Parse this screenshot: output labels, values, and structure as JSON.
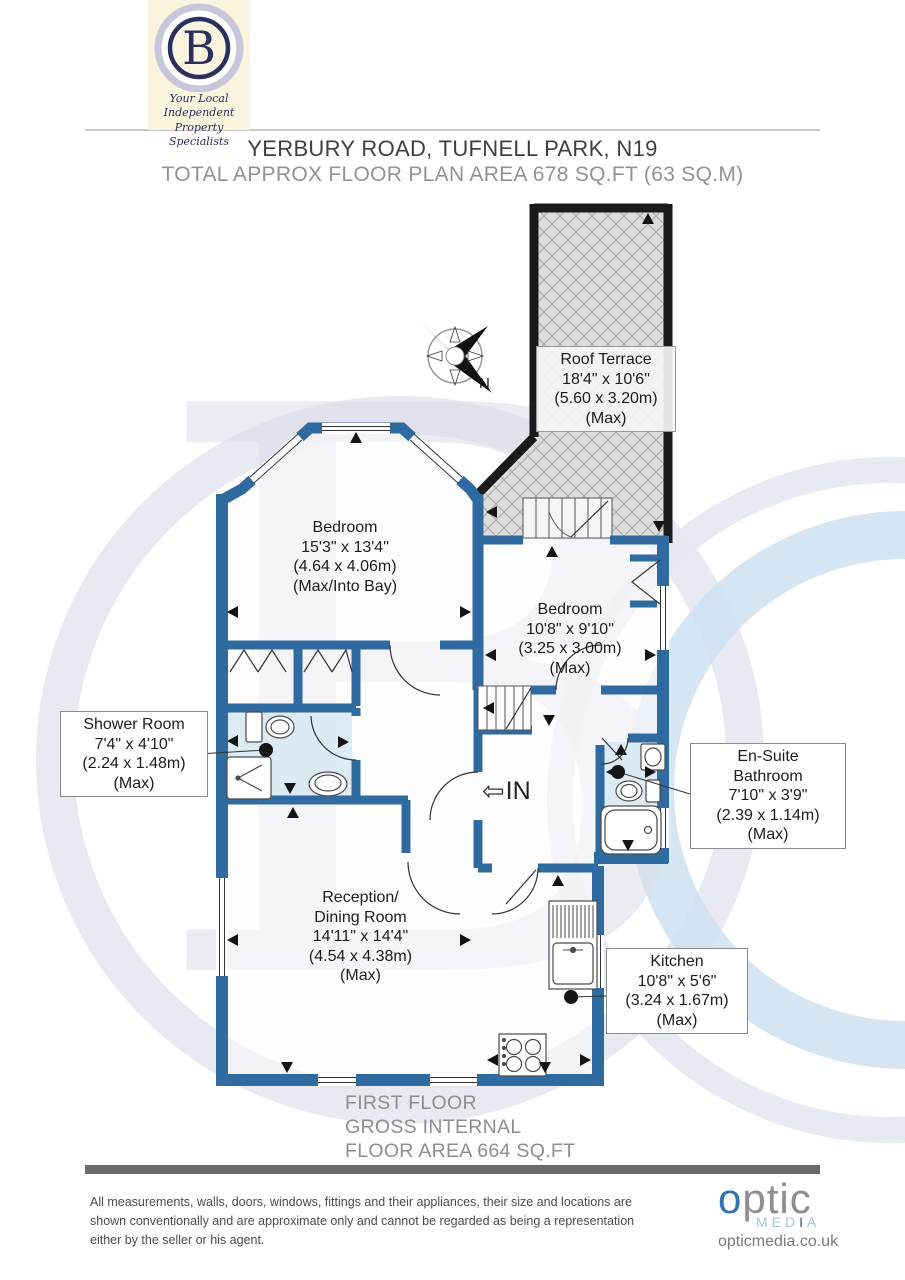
{
  "brand": {
    "letter": "B",
    "tagline_line1": "Your Local Independent",
    "tagline_line2": "Property Specialists"
  },
  "header": {
    "title": "YERBURY ROAD, TUFNELL PARK, N19",
    "subtitle": "TOTAL APPROX FLOOR PLAN AREA 678 SQ.FT (63 SQ.M)"
  },
  "compass": {
    "north": "N"
  },
  "entrance": {
    "label": "IN",
    "arrow_icon": "⇦"
  },
  "rooms": {
    "roof_terrace": {
      "name": "Roof Terrace",
      "imperial": "18'4\" x 10'6\"",
      "metric": "(5.60 x 3.20m)",
      "qualifier": "(Max)"
    },
    "bedroom_front": {
      "name": "Bedroom",
      "imperial": "15'3\" x 13'4\"",
      "metric": "(4.64 x 4.06m)",
      "qualifier": "(Max/Into Bay)"
    },
    "bedroom_rear": {
      "name": "Bedroom",
      "imperial": "10'8\" x 9'10\"",
      "metric": "(3.25 x 3.00m)",
      "qualifier": "(Max)"
    },
    "shower_room": {
      "name": "Shower Room",
      "imperial": "7'4\" x 4'10\"",
      "metric": "(2.24 x 1.48m)",
      "qualifier": "(Max)"
    },
    "ensuite": {
      "name_line1": "En-Suite",
      "name_line2": "Bathroom",
      "imperial": "7'10\" x 3'9\"",
      "metric": "(2.39 x 1.14m)",
      "qualifier": "(Max)"
    },
    "reception": {
      "name_line1": "Reception/",
      "name_line2": "Dining Room",
      "imperial": "14'11\" x 14'4\"",
      "metric": "(4.54 x 4.38m)",
      "qualifier": "(Max)"
    },
    "kitchen": {
      "name": "Kitchen",
      "imperial": "10'8\" x 5'6\"",
      "metric": "(3.24 x 1.67m)",
      "qualifier": "(Max)"
    }
  },
  "floor_summary": {
    "line1": "FIRST FLOOR",
    "line2": "GROSS INTERNAL",
    "line3": "FLOOR AREA 664 SQ.FT"
  },
  "disclaimer": {
    "line1": "All measurements, walls, doors, windows, fittings and their appliances, their size and locations are",
    "line2": "shown conventionally and are approximate only and cannot be regarded as being a representation",
    "line3": "either by the seller or his agent."
  },
  "vendor": {
    "wordmark_first": "o",
    "wordmark_rest": "ptic",
    "media_left": "MED",
    "media_mid": "I",
    "media_right": "A",
    "website": "opticmedia.co.uk"
  },
  "colors": {
    "wall_blue": "#2f6ba1",
    "terrace_wall_black": "#1a1a1a",
    "bathroom_floor": "#d9e9f3",
    "brand_navy": "#2a2f5c",
    "vendor_blue": "#2d74b5",
    "vendor_media_blue": "#a3c6dd"
  }
}
